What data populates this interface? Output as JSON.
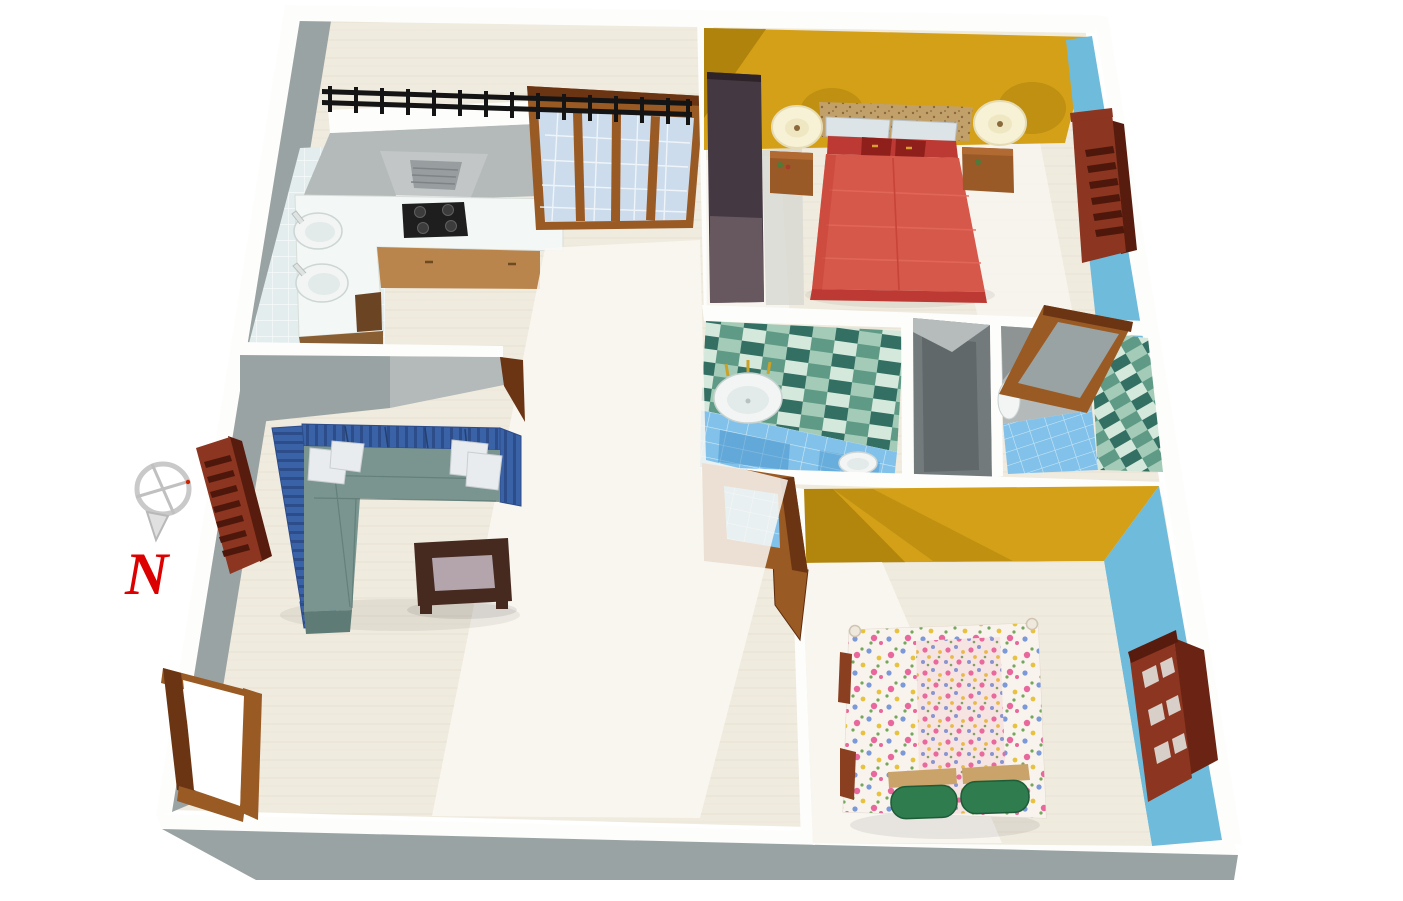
{
  "title_hint": "3d-apartment-floorplan-render",
  "compass": {
    "icon": "compass-crosshair-icon",
    "label": "N",
    "label_color": "#dd0000",
    "ring_color": "#c9c9c9"
  },
  "palette": {
    "white": "#ffffff",
    "wall_top": "#fdfdfc",
    "wall_gray": "#9aa3a3",
    "wall_gray_light": "#b4bab9",
    "wall_gray_mid": "#8e9494",
    "wall_gray_dark": "#60686a",
    "floor": "#f0ebdf",
    "floor_hi": "#faf8f3",
    "floor_shadow": "#d7d8d2",
    "yellow": "#d4a017",
    "yellow_shadow": "#a97f0b",
    "blue_wall": "#6fbbdb",
    "wood": "#9a5a24",
    "wood_dark": "#6b3513",
    "maroon": "#8c3520",
    "maroon_dark": "#571c0e",
    "slat_dark": "#4e170b",
    "slat_light": "#d8cfc9",
    "railing": "#141414",
    "glass": "#ccdcec",
    "glass_grid": "#f2f6fa",
    "counter": "#f3f7f5",
    "cabinet": "#b9854c",
    "cabinet_dark": "#8a5e33",
    "cooktop": "#1e1e1e",
    "burner": "#3c3c3c",
    "hood": "#c2c6c7",
    "hood_dark": "#989ea0",
    "fixture": "#f2f5f4",
    "fixture_shade": "#e2eaea",
    "faucet_gold": "#c9a227",
    "tile_dark": "#336f62",
    "tile_mid": "#5e9a85",
    "tile_light": "#a3cbb8",
    "tile_pale": "#d4e8dc",
    "tile_floor": "#82c2ea",
    "tile_floor_dark": "#4190c8",
    "tile_grid": "#cfe8f6",
    "kitchen_tile": "#e3edee",
    "bed_red": "#d6584a",
    "bed_red_dark": "#bc3a33",
    "bed_red_line": "#e2685c",
    "headboard": "#c2a06a",
    "headboard_dot": "#8a6a3c",
    "pillow_light": "#dde4e8",
    "pillow_red": "#8f1f1a",
    "nightstand": "#9a5a28",
    "nightstand_top": "#b06a32",
    "lamp": "#f7f1d6",
    "lamp_inner": "#efe7c2",
    "wardrobe": "#443843",
    "wardrobe_light": "#6b5b63",
    "closet": "#737a7c",
    "sofa_blue": "#3a62a6",
    "sofa_blue_dark": "#2c4c8a",
    "sofa_seat": "#7a9590",
    "sofa_seat_dark": "#5f7b76",
    "pillow_white": "#e9ecee",
    "table": "#46291f",
    "table_panel": "#b3a5ab",
    "floral_base": "#f8f3ec",
    "floral_pink": "#e8679c",
    "floral_blue": "#7b99d8",
    "floral_yellow": "#e7c23f",
    "floral_green": "#74a65c",
    "pillow_green": "#2f7c4e",
    "pillow_green_dark": "#1e5c38",
    "bar_tan": "#c9a36a"
  }
}
